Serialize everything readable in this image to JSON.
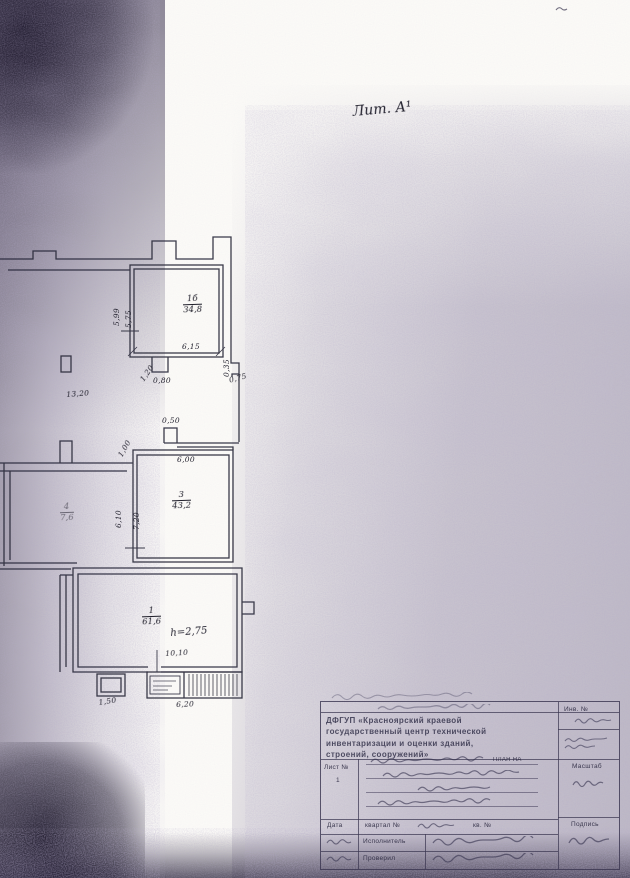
{
  "scan": {
    "lit_label": "Лит. А¹",
    "ink_color": "#2b2a3a",
    "noise_color": "#8f87a3",
    "paper_color": "#fbfaf7"
  },
  "plan": {
    "rooms": {
      "r1b": {
        "number": "1б",
        "area": "34,8"
      },
      "r3": {
        "number": "3",
        "area": "43,2"
      },
      "r4": {
        "number": "4",
        "area": "7,6"
      },
      "r1": {
        "number": "1",
        "area": "61,6"
      }
    },
    "height_note": "h=2,75",
    "dims": {
      "d599": "5,99",
      "d575": "5,75",
      "d615": "6,15",
      "d120": "1,20",
      "d080": "0,80",
      "d035": "0,35",
      "d075": "0,75",
      "d1320": "13,20",
      "d050": "0,50",
      "d100": "1,00",
      "d600": "6,00",
      "d610": "6,10",
      "d720": "7,20",
      "d1010": "10,10",
      "d150": "1,50",
      "d620": "6,20"
    }
  },
  "title_block": {
    "org_lines": [
      "ДФГУП «Красноярский краевой",
      "государственный центр технической",
      "инвентаризации и оценки зданий,",
      "строений, сооружений»"
    ],
    "inv_label": "Инв. №",
    "sheet_label": "Лист №",
    "sheet_number": "1",
    "plan_caption": "план на",
    "scale_label": "Масштаб",
    "sign_label": "Подпись",
    "quarter_label": "квартал №",
    "apt_label": "кв. №",
    "date_label": "Дата",
    "executor_label": "Исполнитель",
    "checker_label": "Проверил"
  }
}
